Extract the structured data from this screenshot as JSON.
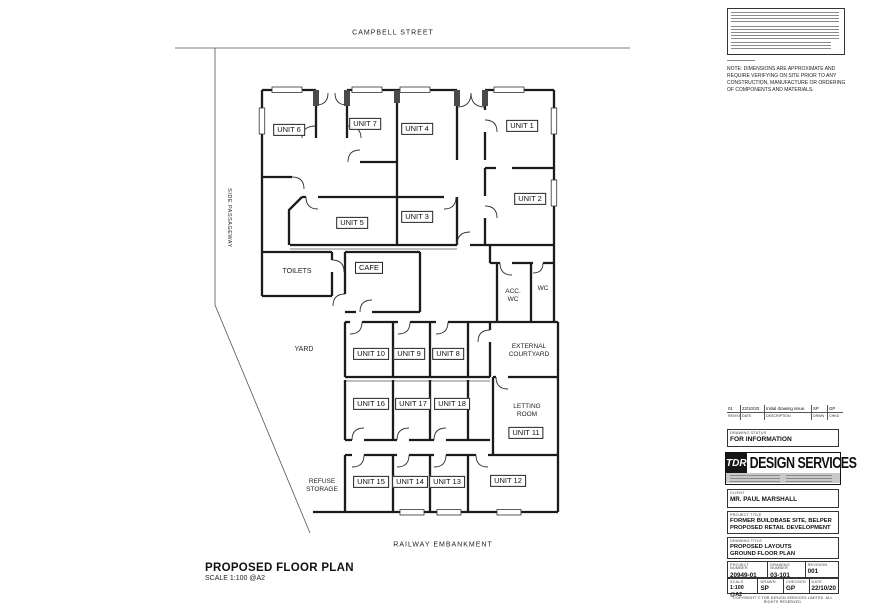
{
  "sheet": {
    "title": "PROPOSED FLOOR PLAN",
    "scale": "SCALE 1:100 @A2"
  },
  "plan": {
    "streets": {
      "top": "CAMPBELL STREET",
      "bottom": "RAILWAY EMBANKMENT",
      "left": "SIDE PASSAGEWAY"
    },
    "units": [
      "UNIT 6",
      "UNIT 7",
      "UNIT 4",
      "UNIT 1",
      "UNIT 2",
      "UNIT 5",
      "UNIT 3",
      "UNIT 10",
      "UNIT 9",
      "UNIT 8",
      "UNIT 16",
      "UNIT 17",
      "UNIT 18",
      "UNIT 11",
      "UNIT 15",
      "UNIT 14",
      "UNIT 13",
      "UNIT 12",
      "CAFE"
    ],
    "areas": {
      "toilets": "TOILETS",
      "acc_wc": "ACC. WC",
      "wc": "WC",
      "yard": "YARD",
      "refuse": "REFUSE STORAGE",
      "courtyard": "EXTERNAL COURTYARD",
      "letting": "LETTING ROOM"
    }
  },
  "tb": {
    "note": "NOTE: DIMENSIONS ARE APPROXIMATE AND REQUIRE VERIFYING ON SITE PRIOR TO ANY CONSTRUCTION, MANUFACTURE OR ORDERING OF COMPONENTS AND MATERIALS.",
    "rev": {
      "row": {
        "rev": "01",
        "date": "22/10/20",
        "desc": "Initial drawing issue.",
        "drawn": "SP",
        "checked": "GP"
      },
      "headers": {
        "rev": "REVISION",
        "date": "DATE",
        "desc": "DESCRIPTION",
        "drawn": "DRWN",
        "checked": "CHKD"
      }
    },
    "status": {
      "caption": "DRAWING STATUS",
      "value": "FOR INFORMATION"
    },
    "logo": {
      "abbr": "TDR",
      "name": "DESIGN SERVICES"
    },
    "client": {
      "caption": "CLIENT",
      "value": "MR. PAUL MARSHALL"
    },
    "project": {
      "caption": "PROJECT TITLE",
      "line1": "FORMER BUILDBASE SITE, BELPER",
      "line2": "PROPOSED RETAIL DEVELOPMENT"
    },
    "drawing": {
      "caption": "DRAWING TITLE",
      "line1": "PROPOSED LAYOUTS",
      "line2": "GROUND FLOOR PLAN"
    },
    "fields": {
      "project_number": {
        "label": "PROJECT NUMBER",
        "value": "20949-01"
      },
      "drawing_number": {
        "label": "DRAWING NUMBER",
        "value": "03-101"
      },
      "revision": {
        "label": "REVISION",
        "value": "001"
      },
      "scale": {
        "label": "SCALE",
        "value": "1:100 @A2"
      },
      "drawn": {
        "label": "DRAWN",
        "value": "SP"
      },
      "checked": {
        "label": "CHECKED",
        "value": "GP"
      },
      "date": {
        "label": "DATE",
        "value": "22/10/20"
      }
    },
    "copyright": "COPYRIGHT © TDR DESIGN SERVICES LIMITED. ALL RIGHTS RESERVED."
  }
}
